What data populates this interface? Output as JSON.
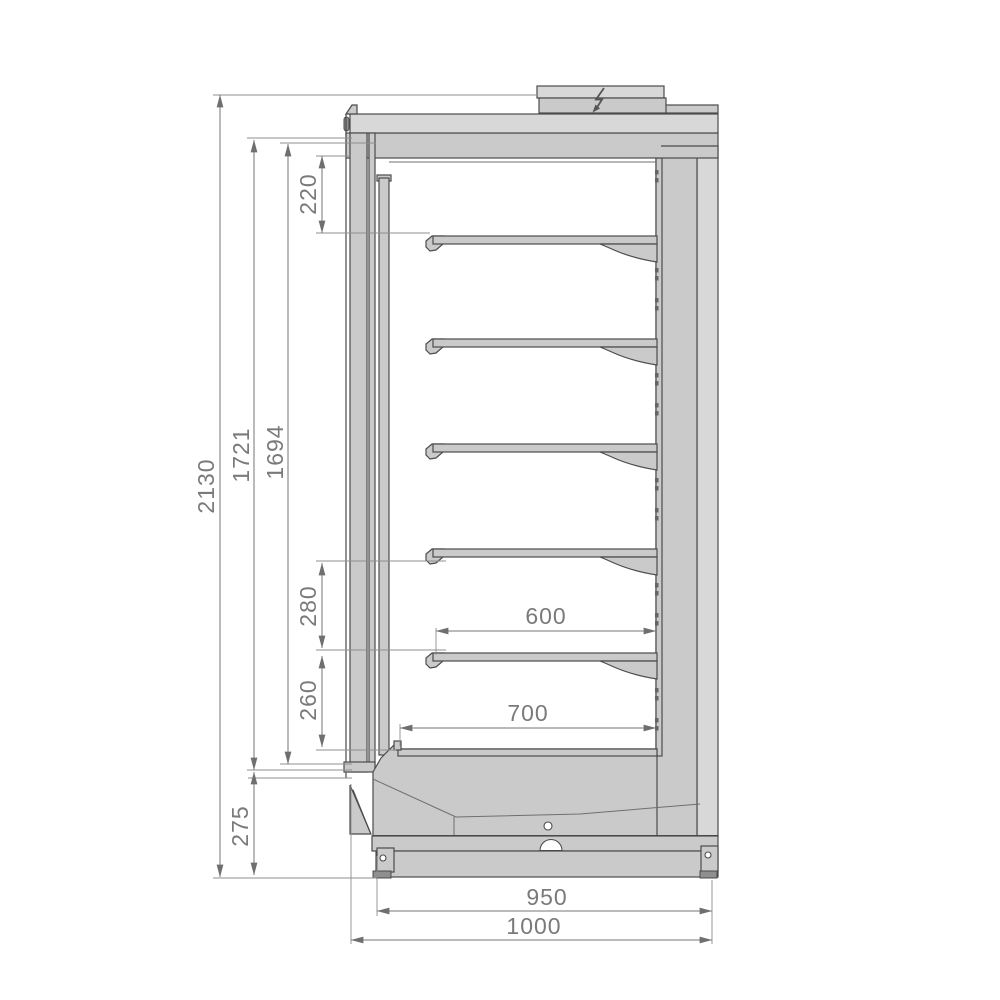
{
  "drawing": {
    "dimensions_mm": {
      "total_height": "2130",
      "upper_height": "1721",
      "inner_height": "1694",
      "top_section": "220",
      "shelf_gap_upper": "280",
      "shelf_gap_lower": "260",
      "base_height": "275",
      "shelf_depth": "600",
      "deck_depth": "700",
      "base_depth": "950",
      "total_depth": "1000"
    },
    "shelf_count": 5,
    "power_icon": "lightning-bolt",
    "colors": {
      "outline": "#4b4b4b",
      "part_fill": "#cacaca",
      "part_fill_light": "#d8d8d8",
      "dimension": "#767676",
      "background": "#ffffff"
    }
  }
}
